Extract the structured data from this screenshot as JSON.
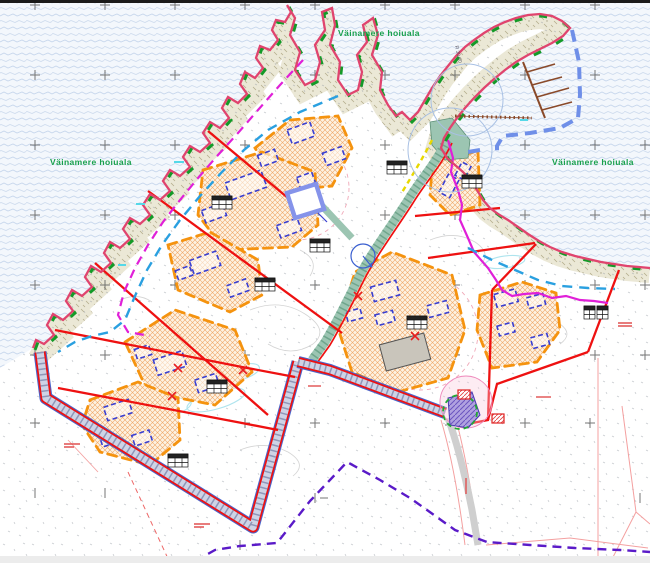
{
  "map": {
    "labels": {
      "hoiuala_west": "Väinamere hoiuala",
      "hoiuala_top": "Väinamere hoiuala",
      "hoiuala_right": "Väinamere hoiuala",
      "radius_label": "R 30.00"
    },
    "colors": {
      "sea_wave": "#c6d6ec",
      "coastline_red": "#e0446e",
      "conservation_green": "#18a04c",
      "boundary_red": "#ee1111",
      "envelope_orange": "#f5930f",
      "building_blue": "#3a3fd0",
      "plot_square_blue": "#8593ea",
      "road_teal": "#9cc5b2",
      "harbor_blue": "#6f8fe8",
      "pier_brown": "#8a4a2a",
      "utility_purple": "#5a1ac8",
      "magenta_line": "#e020d8",
      "cyan_dashed": "#2aa0e0",
      "cadastral_pink": "#f4a0a0"
    }
  }
}
